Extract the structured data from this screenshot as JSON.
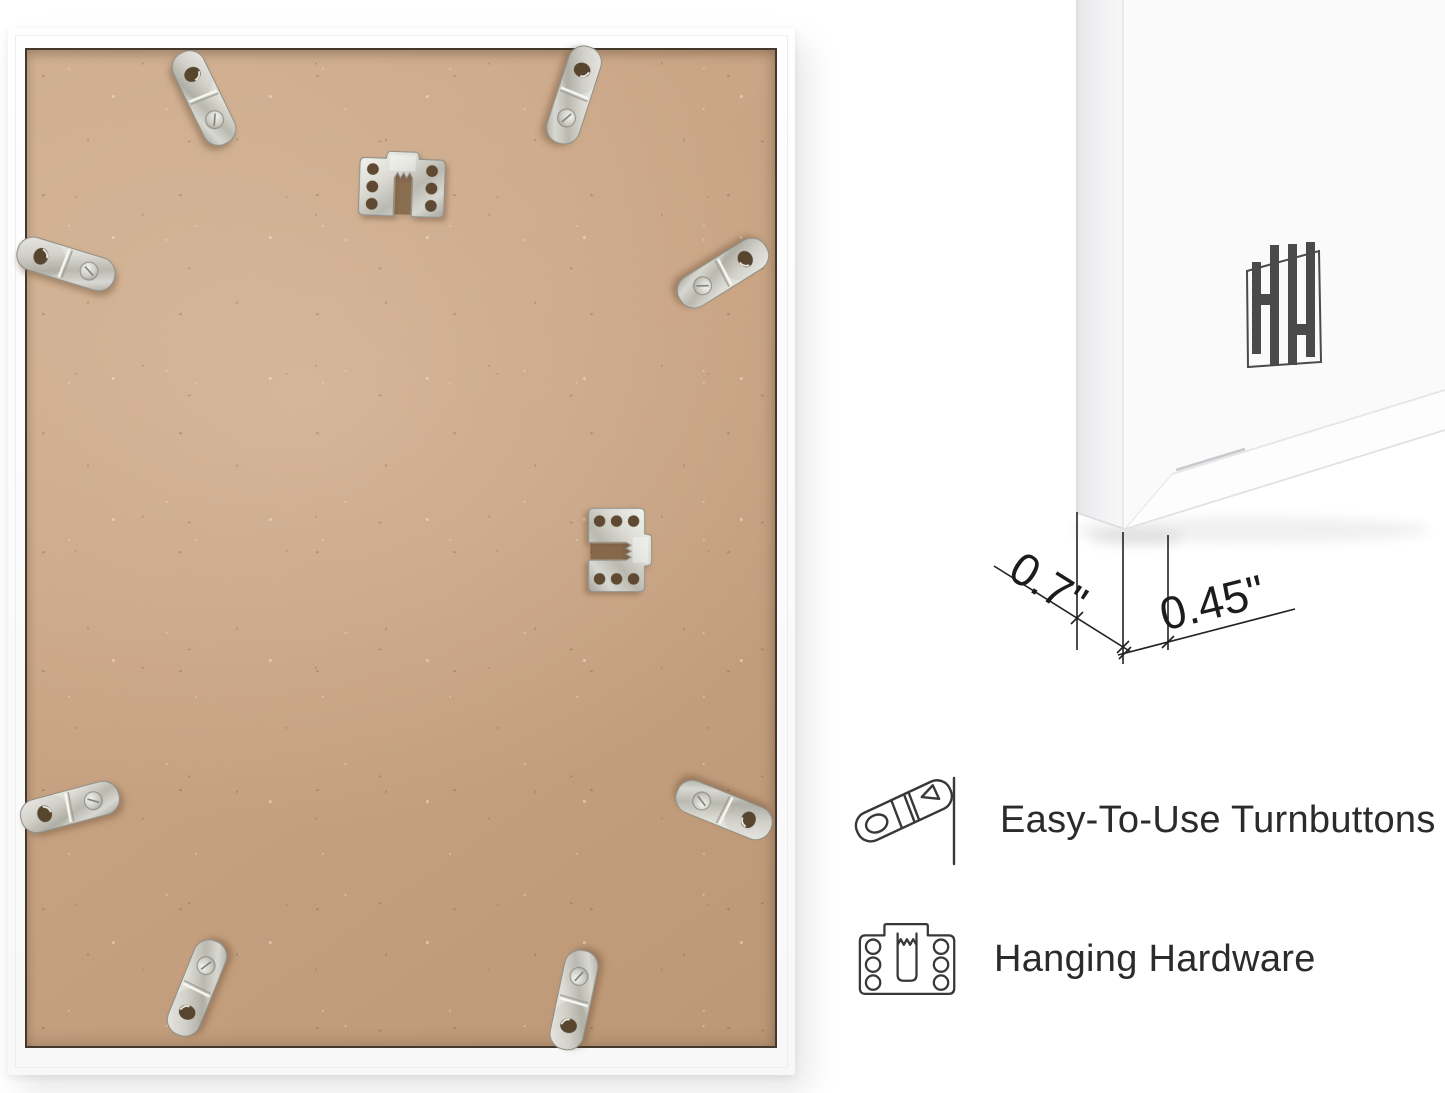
{
  "scene": {
    "background_color": "#ffffff",
    "description": "Back of white picture frame with mounting hardware, corner detail with measurements, and feature callouts"
  },
  "frame_back": {
    "molding_color": "#fbfbfb",
    "board_color": "#c8a384",
    "seam_color": "#42382b",
    "turnbutton_count": 8,
    "sawtooth_hanger_count": 2
  },
  "corner_detail": {
    "logo_icon": "hh-monogram-logo",
    "logo_color": "#4a4a4a",
    "depth_dimension": "0.7\"",
    "face_dimension": "0.45\"",
    "line_color": "#222222"
  },
  "features": [
    {
      "icon": "turnbutton-icon",
      "label": "Easy-To-Use Turnbuttons"
    },
    {
      "icon": "hanging-hardware-icon",
      "label": "Hanging Hardware"
    }
  ],
  "text_color": "#2b2b2b"
}
